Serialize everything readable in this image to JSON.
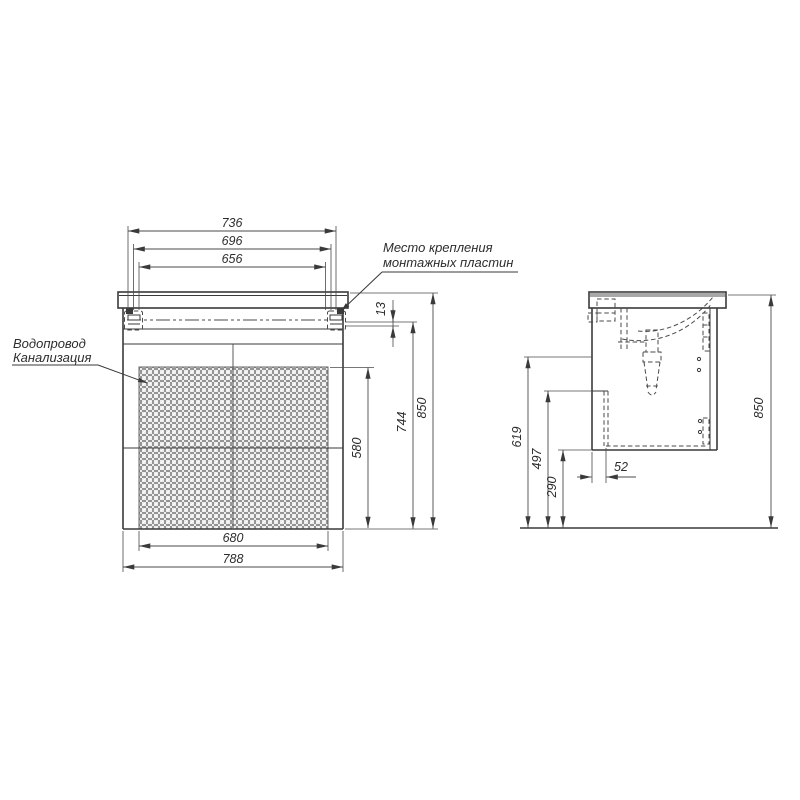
{
  "labels": {
    "mounting_line1": "Место крепления",
    "mounting_line2": "монтажных пластин",
    "plumbing_line1": "Водопровод",
    "plumbing_line2": "Канализация"
  },
  "front_dims": {
    "d736": "736",
    "d696": "696",
    "d656": "656",
    "d13": "13",
    "d580": "580",
    "d744": "744",
    "d850": "850",
    "d680": "680",
    "d788": "788"
  },
  "side_dims": {
    "d619": "619",
    "d497": "497",
    "d290": "290",
    "d52": "52",
    "d850": "850"
  },
  "colors": {
    "line": "#3a3a3a",
    "hatch": "#6f6f6f",
    "counter_strip": "#a8a8a8",
    "background": "#ffffff"
  }
}
